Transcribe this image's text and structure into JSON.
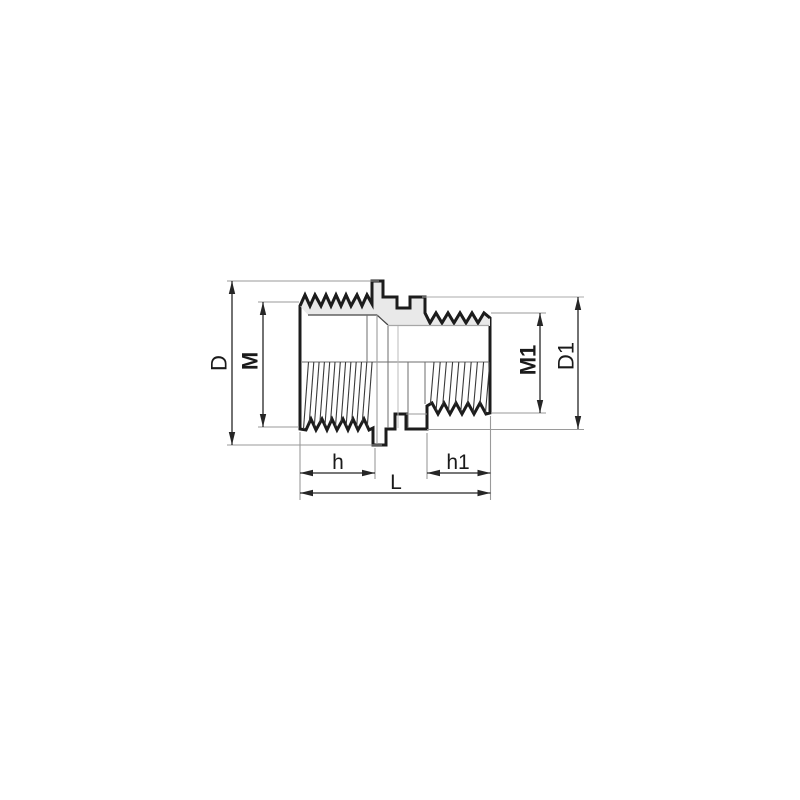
{
  "drawing": {
    "dimensions": [
      {
        "id": "D",
        "label": "D",
        "orientation": "vertical",
        "side": "left",
        "weight": "regular"
      },
      {
        "id": "M",
        "label": "M",
        "orientation": "vertical",
        "side": "left",
        "weight": "bold"
      },
      {
        "id": "M1",
        "label": "M1",
        "orientation": "vertical",
        "side": "right",
        "weight": "bold"
      },
      {
        "id": "D1",
        "label": "D1",
        "orientation": "vertical",
        "side": "right",
        "weight": "regular"
      },
      {
        "id": "h",
        "label": "h",
        "orientation": "horizontal",
        "side": "bottom",
        "weight": "regular"
      },
      {
        "id": "h1",
        "label": "h1",
        "orientation": "horizontal",
        "side": "bottom",
        "weight": "regular"
      },
      {
        "id": "L",
        "label": "L",
        "orientation": "horizontal",
        "side": "bottom",
        "weight": "regular"
      }
    ],
    "colors": {
      "background": "#ffffff",
      "outline": "#1c1c1c",
      "section_fill": "#e9e9e9",
      "thread_line": "#3a3a3a",
      "dimension_line": "#262626",
      "extension_line": "#9a9a9a",
      "text": "#1a1a1a"
    }
  }
}
